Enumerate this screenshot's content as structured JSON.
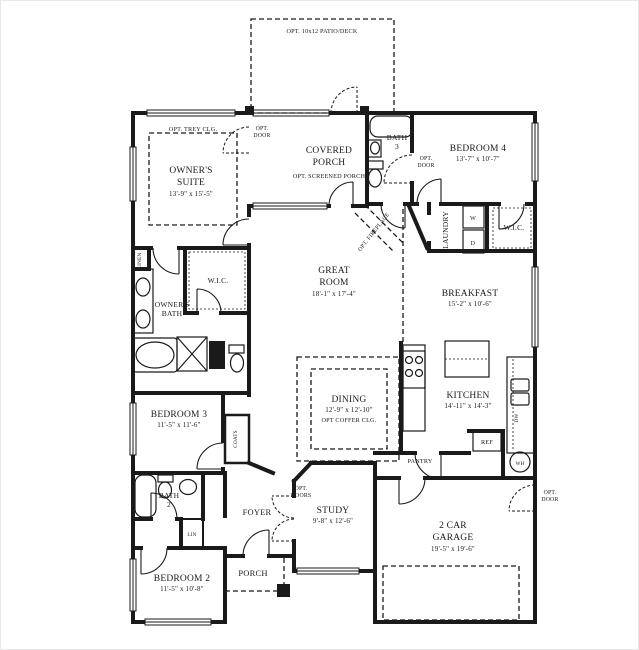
{
  "colors": {
    "line": "#1a1a1a",
    "bg": "#ffffff"
  },
  "plan": {
    "patio": {
      "label": "OPT. 10x12 PATIO/DECK"
    },
    "owners_suite": {
      "line1": "OWNER'S",
      "line2": "SUITE",
      "dim": "13'-9\" x 15'-5\"",
      "ceiling": "OPT. TREY CLG."
    },
    "covered_porch": {
      "line1": "COVERED",
      "line2": "PORCH",
      "option": "OPT. SCREENED PORCH"
    },
    "bath3": {
      "line1": "BATH",
      "line2": "3"
    },
    "bedroom4": {
      "name": "BEDROOM 4",
      "dim": "13'-7\" x 10'-7\""
    },
    "laundry": {
      "name": "LAUNDRY",
      "washer": "W",
      "dryer": "D"
    },
    "wic_rear": {
      "name": "W.I.C."
    },
    "great_room": {
      "line1": "GREAT",
      "line2": "ROOM",
      "dim": "18'-1\" x 17'-4\""
    },
    "breakfast": {
      "name": "BREAKFAST",
      "dim": "15'-2\" x 10'-6\""
    },
    "fireplace": {
      "label": "OPT. FIREPLACE"
    },
    "owners_wic": {
      "name": "W.I.C."
    },
    "owners_bath": {
      "line1": "OWNER'S",
      "line2": "BATH"
    },
    "linen": {
      "name": "LINEN"
    },
    "dining": {
      "name": "DINING",
      "dim": "12'-9\" x 12'-10\"",
      "ceiling": "OPT COFFER CLG."
    },
    "kitchen": {
      "name": "KITCHEN",
      "dim": "14'-11\" x 14'-3\""
    },
    "pantry": {
      "name": "PANTRY"
    },
    "ref": {
      "name": "REF"
    },
    "dw": {
      "name": "DW"
    },
    "wh": {
      "name": "WH"
    },
    "bedroom3": {
      "name": "BEDROOM 3",
      "dim": "11'-5\" x 11'-6\""
    },
    "coats": {
      "name": "COATS"
    },
    "bath2": {
      "line1": "BATH",
      "line2": "2"
    },
    "lin": {
      "name": "LIN"
    },
    "foyer": {
      "name": "FOYER"
    },
    "study": {
      "name": "STUDY",
      "dim": "9'-8\" x 12'-6\""
    },
    "opt_doors": {
      "line1": "OPT.",
      "line2": "DOORS"
    },
    "garage": {
      "line1": "2 CAR",
      "line2": "GARAGE",
      "dim": "19'-5\" x 19'-6\""
    },
    "bedroom2": {
      "name": "BEDROOM 2",
      "dim": "11'-5\" x 10'-8\""
    },
    "porch": {
      "name": "PORCH"
    },
    "opt_door": {
      "line1": "OPT.",
      "line2": "DOOR"
    }
  }
}
